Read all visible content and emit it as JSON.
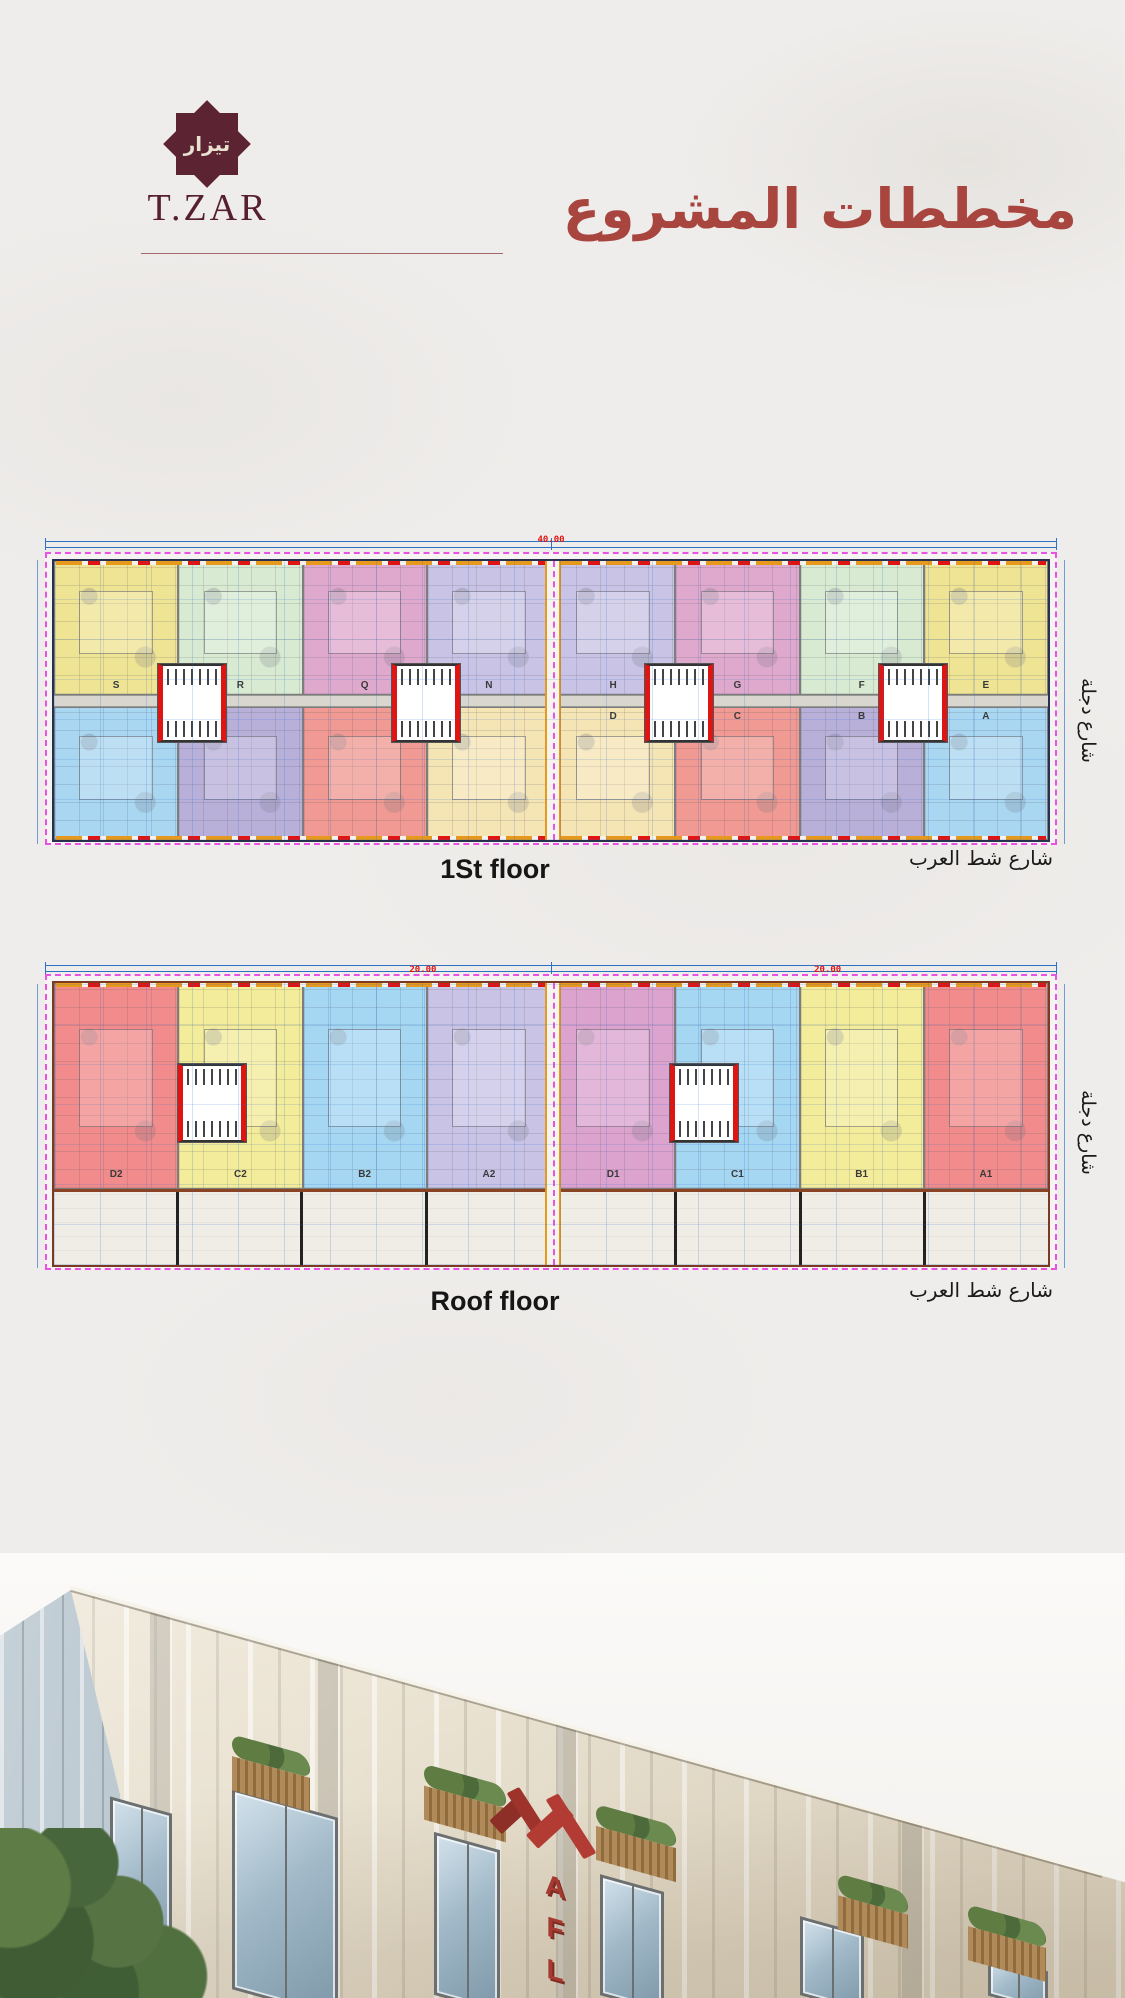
{
  "header": {
    "brand_arabic": "تيزار",
    "brand_latin": "T.ZAR",
    "title_arabic": "مخططات المشروع"
  },
  "plan_first": {
    "floor_label": "1St floor",
    "street_bottom": "شارع شط العرب",
    "street_side": "شارع دجلة",
    "dim_top": "40.00",
    "row_top": [
      {
        "label": "S",
        "color": "#efe394"
      },
      {
        "label": "R",
        "color": "#d8ebd2"
      },
      {
        "label": "Q",
        "color": "#dfa9cd"
      },
      {
        "label": "N",
        "color": "#c9c4e6"
      },
      {
        "label": "H",
        "color": "#c9c4e6"
      },
      {
        "label": "G",
        "color": "#dfa9cd"
      },
      {
        "label": "F",
        "color": "#d8ebd2"
      },
      {
        "label": "E",
        "color": "#efe394"
      }
    ],
    "row_bottom": [
      {
        "label": "",
        "color": "#a9d7f1"
      },
      {
        "label": "",
        "color": "#b9b0da"
      },
      {
        "label": "",
        "color": "#f09a93"
      },
      {
        "label": "",
        "color": "#f5e5b5"
      },
      {
        "label": "D",
        "color": "#f5e5b5"
      },
      {
        "label": "C",
        "color": "#f09a93"
      },
      {
        "label": "B",
        "color": "#b9b0da"
      },
      {
        "label": "A",
        "color": "#a9d7f1"
      }
    ]
  },
  "plan_roof": {
    "floor_label": "Roof floor",
    "street_bottom": "شارع شط العرب",
    "street_side": "شارع دجلة",
    "dim_left": "20.00",
    "dim_right": "20.00",
    "units": [
      {
        "label": "D2",
        "color": "#f28b8b"
      },
      {
        "label": "C2",
        "color": "#f3ec9a"
      },
      {
        "label": "B2",
        "color": "#a5d7f3"
      },
      {
        "label": "A2",
        "color": "#c9c3e6"
      },
      {
        "label": "D1",
        "color": "#dca3cf"
      },
      {
        "label": "C1",
        "color": "#a5d7f3"
      },
      {
        "label": "B1",
        "color": "#f3ec9a"
      },
      {
        "label": "A1",
        "color": "#f28b8b"
      }
    ],
    "terraces": [
      "",
      "",
      "",
      "",
      "",
      "",
      "",
      ""
    ]
  },
  "photo": {
    "sign_letters": [
      "A",
      "F",
      "L",
      "A"
    ]
  },
  "colors": {
    "brand_maroon": "#5c2433",
    "title_red": "#a8453e",
    "cad_blue": "#2b72c4",
    "cad_magenta": "#ea52e2",
    "cad_orange": "#e6991c",
    "cad_red": "#de1512",
    "sign_red": "#a63a30"
  }
}
